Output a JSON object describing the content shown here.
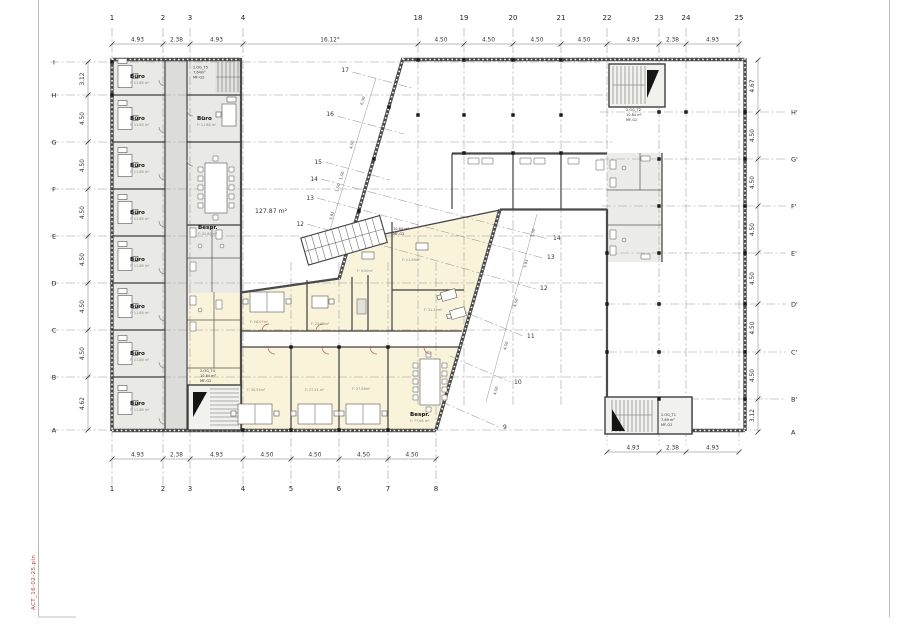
{
  "sheet": {
    "filename": "ACT_16-02-25.pln"
  },
  "grid": {
    "top_numbers": [
      "1",
      "2",
      "3",
      "4",
      "18",
      "19",
      "20",
      "21",
      "22",
      "23",
      "24",
      "25"
    ],
    "bottom_numbers": [
      "1",
      "2",
      "3",
      "4",
      "5",
      "6",
      "7",
      "8"
    ],
    "left_letters": [
      "I",
      "H",
      "G",
      "F",
      "E",
      "D",
      "C",
      "B",
      "A"
    ],
    "right_letters": [
      "H'",
      "G'",
      "F'",
      "E'",
      "D'",
      "C'",
      "B'",
      "A"
    ],
    "diagonal_left": [
      "17",
      "16",
      "15",
      "14",
      "13",
      "12"
    ],
    "diagonal_right": [
      "14",
      "13",
      "12",
      "11",
      "10",
      "9"
    ]
  },
  "dims": {
    "top": [
      "4.93",
      "2.38",
      "4.93",
      "16.12°",
      "4.50",
      "4.50",
      "4.50",
      "4.50",
      "4.93",
      "2.38",
      "4.93"
    ],
    "bottom": [
      "4.93",
      "2.38",
      "4.93",
      "4.50",
      "4.50",
      "4.50",
      "4.50"
    ],
    "bottom_right": [
      "4.93",
      "2.38",
      "4.93"
    ],
    "left": [
      "3.12",
      "4.50",
      "4.50",
      "4.50",
      "4.50",
      "4.50",
      "4.50",
      "4.62"
    ],
    "right": [
      "4.67",
      "4.50",
      "4.50",
      "4.50",
      "4.50",
      "4.50",
      "4.50",
      "3.12"
    ],
    "diagonal_chain_left": [
      "6.30",
      "4.50",
      "1.50",
      "1.50",
      "3.92"
    ],
    "diagonal_chain_right": [
      "1.50",
      "3.93",
      "4.50",
      "4.50",
      "4.50"
    ]
  },
  "rooms": {
    "office_label": "Büro",
    "offices_west_area": "F: 11.88 m²",
    "office_east_area": "F: 11.88 m²",
    "bespr_label": "Bespr.",
    "bespr_west_area": "F: 42.80 m²",
    "bespr_south_area": "F: 77.66 m²",
    "open_area": "127.87 m²",
    "yellow_areas": [
      "F: 28.07m²",
      "F: 25.08m²",
      "F: 31.29m²",
      "F: 9.50m²",
      "F: 11.98m²",
      "F: 30.55m²",
      "F: 27.21 m²",
      "F: 27.56m²"
    ]
  },
  "stairs": {
    "t5": [
      "2.OG_T5",
      "7.64m²",
      "MF-G2"
    ],
    "t2": [
      "2.OG_T2",
      "10.84 m²",
      "MF-G2"
    ],
    "t3": [
      "10.84 m²",
      "MF-G2"
    ],
    "t4": [
      "2.OG_T4",
      "10.84 m²",
      "MF-G2"
    ],
    "t1": [
      "2.OG_T1",
      "7.69 m²",
      "MF-G2"
    ]
  }
}
